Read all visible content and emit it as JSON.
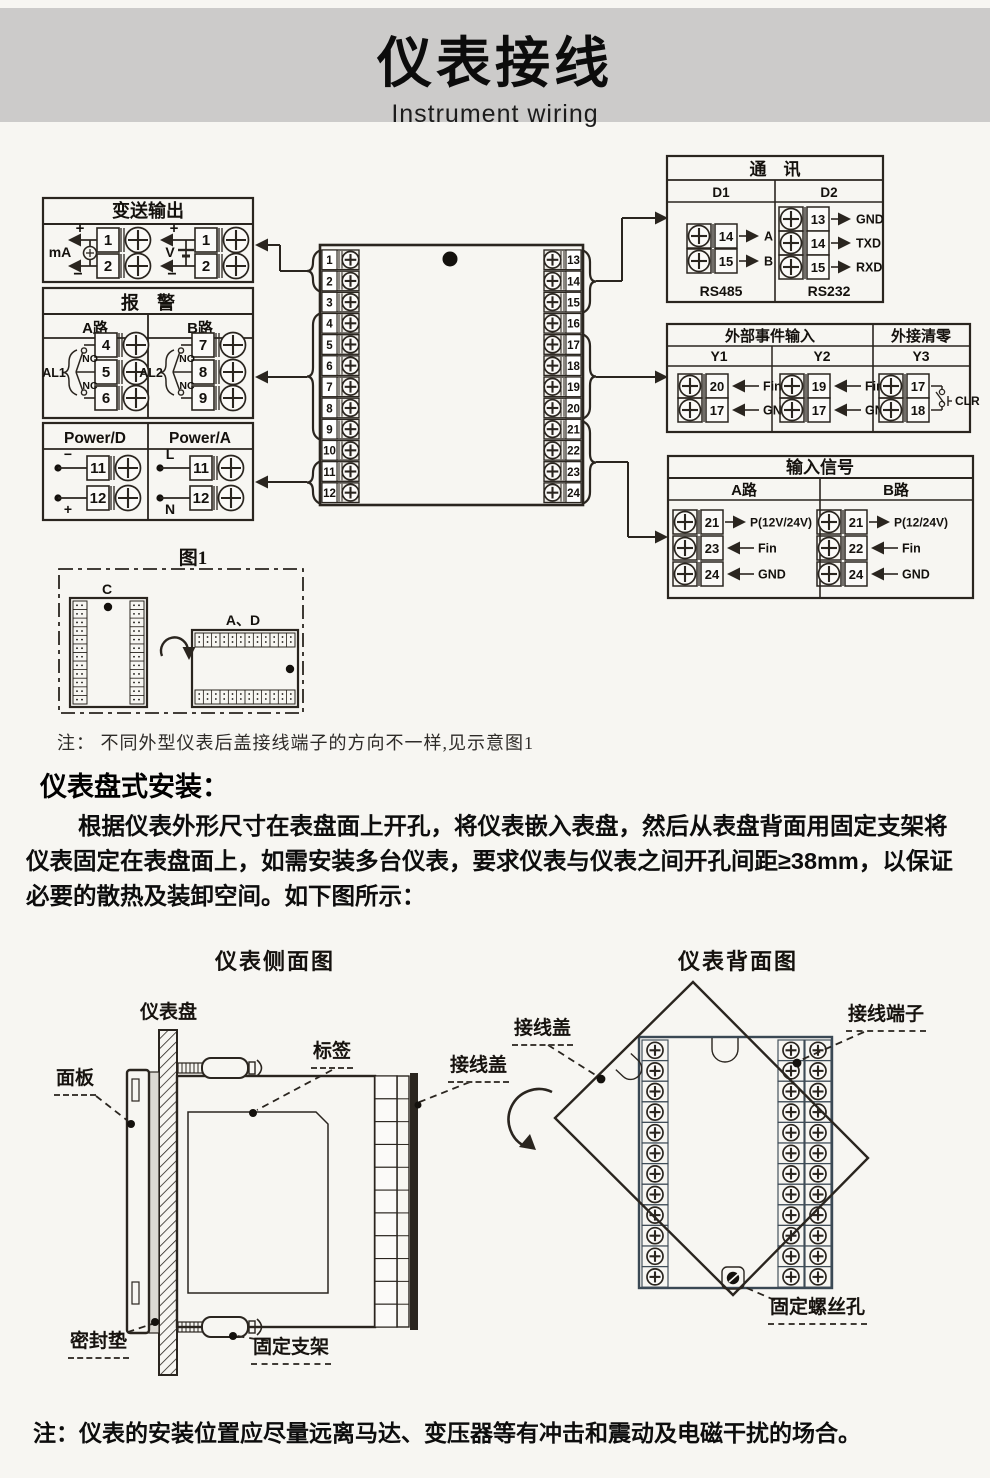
{
  "header": {
    "title": "仪表接线",
    "subtitle": "Instrument wiring"
  },
  "colors": {
    "ink": "#2a251f",
    "header_band": "#cccbca",
    "page_bg": "#f7f6f2",
    "panel_stroke": "#3a4854"
  },
  "wiring": {
    "transmitter": {
      "title": "变送输出",
      "groups": [
        {
          "signal": "mA",
          "plus": "+",
          "minus": "−",
          "source": "current",
          "terminals": [
            "1",
            "2"
          ]
        },
        {
          "signal": "V",
          "plus": "+",
          "minus": "−",
          "source": "battery",
          "terminals": [
            "1",
            "2"
          ]
        }
      ]
    },
    "alarm": {
      "title": "报　警",
      "channels": [
        {
          "name": "A路",
          "relay": "AL1",
          "no": "NO",
          "nc": "NC",
          "terminals": [
            "4",
            "5",
            "6"
          ]
        },
        {
          "name": "B路",
          "relay": "AL2",
          "no": "NO",
          "nc": "NC",
          "terminals": [
            "7",
            "8",
            "9"
          ]
        }
      ]
    },
    "power": {
      "columns": [
        {
          "name": "Power/D",
          "rows": [
            {
              "num": "11",
              "tag": "−"
            },
            {
              "num": "12",
              "tag": "+"
            }
          ]
        },
        {
          "name": "Power/A",
          "rows": [
            {
              "num": "11",
              "tag": "L"
            },
            {
              "num": "12",
              "tag": "N"
            }
          ]
        }
      ]
    },
    "center": {
      "left": [
        "1",
        "2",
        "3",
        "4",
        "5",
        "6",
        "7",
        "8",
        "9",
        "10",
        "11",
        "12"
      ],
      "right": [
        "13",
        "14",
        "15",
        "16",
        "17",
        "18",
        "19",
        "20",
        "21",
        "22",
        "23",
        "24"
      ]
    },
    "comm": {
      "title": "通　讯",
      "columns": [
        {
          "name": "D1",
          "proto": "RS485",
          "rows": [
            {
              "num": "14",
              "tag": "A"
            },
            {
              "num": "15",
              "tag": "B"
            }
          ]
        },
        {
          "name": "D2",
          "proto": "RS232",
          "rows": [
            {
              "num": "13",
              "tag": "GND"
            },
            {
              "num": "14",
              "tag": "TXD"
            },
            {
              "num": "15",
              "tag": "RXD"
            }
          ]
        }
      ]
    },
    "event": {
      "title_main": "外部事件输入",
      "title_clear": "外接清零",
      "columns": [
        {
          "name": "Y1",
          "rows": [
            {
              "num": "20",
              "tag": "Fin"
            },
            {
              "num": "17",
              "tag": "GND"
            }
          ]
        },
        {
          "name": "Y2",
          "rows": [
            {
              "num": "19",
              "tag": "Fin"
            },
            {
              "num": "17",
              "tag": "GND"
            }
          ]
        },
        {
          "name": "Y3",
          "rows": [
            {
              "num": "17"
            },
            {
              "num": "18"
            }
          ],
          "clr": "CLR"
        }
      ]
    },
    "input": {
      "title": "输入信号",
      "columns": [
        {
          "name": "A路",
          "rows": [
            {
              "num": "21",
              "dir": "out",
              "tag": "P(12V/24V)"
            },
            {
              "num": "23",
              "dir": "in",
              "tag": "Fin"
            },
            {
              "num": "24",
              "dir": "in",
              "tag": "GND"
            }
          ]
        },
        {
          "name": "B路",
          "rows": [
            {
              "num": "21",
              "dir": "out",
              "tag": "P(12/24V)"
            },
            {
              "num": "22",
              "dir": "in",
              "tag": "Fin"
            },
            {
              "num": "24",
              "dir": "in",
              "tag": "GND"
            }
          ]
        }
      ]
    },
    "fig1": {
      "caption": "图1",
      "case_c": "C",
      "case_ad": "A、D"
    }
  },
  "notes": {
    "fig_note": "注： 不同外型仪表后盖接线端子的方向不一样,见示意图1",
    "bottom_note": "注：仪表的安装位置应尽量远离马达、变压器等有冲击和震动及电磁干扰的场合。"
  },
  "install": {
    "heading": "仪表盘式安装：",
    "paragraph": "根据仪表外形尺寸在表盘面上开孔，将仪表嵌入表盘，然后从表盘背面用固定支架将仪表固定在表盘面上，如需安装多台仪表，要求仪表与仪表之间开孔间距≥38mm，以保证必要的散热及装卸空间。如下图所示："
  },
  "views": {
    "side_heading": "仪表侧面图",
    "back_heading": "仪表背面图",
    "side_labels": {
      "panel_board": "仪表盘",
      "front_panel": "面板",
      "sticker": "标签",
      "terminal_cover": "接线盖",
      "gasket": "密封垫",
      "bracket": "固定支架"
    },
    "back_labels": {
      "terminal_cover": "接线盖",
      "terminals": "接线端子",
      "screw_hole": "固定螺丝孔"
    }
  }
}
